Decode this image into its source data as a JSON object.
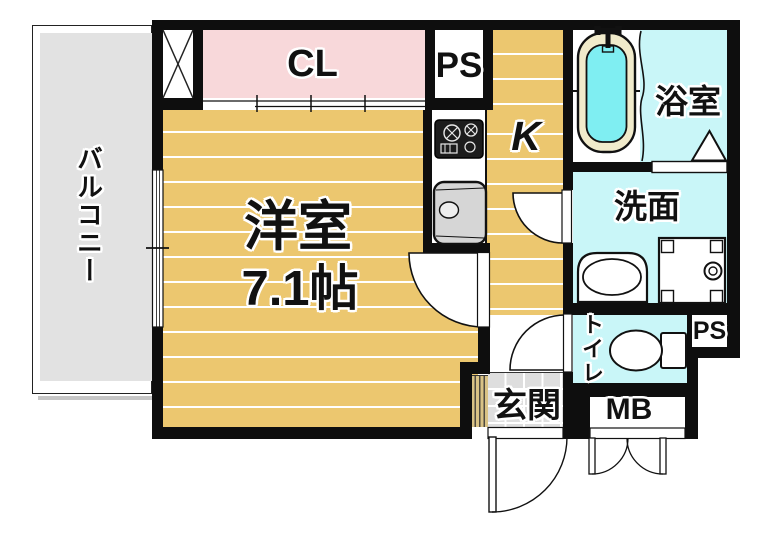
{
  "floorplan": {
    "title": "1K apartment floor plan",
    "labels": {
      "balcony": "バルコニー",
      "closet": "CL",
      "pipe_space_top": "PS",
      "kitchen": "K",
      "room_name": "洋室",
      "room_size": "7.1帖",
      "bathroom": "浴室",
      "washroom": "洗面",
      "toilet": "トイレ",
      "pipe_space_bottom": "PS",
      "meter_box": "MB",
      "entrance": "玄関"
    },
    "colors": {
      "wall": "#0e0e0e",
      "room_tan": "#ecc76f",
      "closet_pink": "#f8d8da",
      "wet_cyan": "#c9f6f8",
      "tub_water": "#7feef2",
      "tub_rim": "#f1ebcb",
      "balcony_gray": "#e2e2e2",
      "tile_gray": "#dedede",
      "step_tan": "#d9c285",
      "sink_gray": "#d6d6d6"
    }
  }
}
